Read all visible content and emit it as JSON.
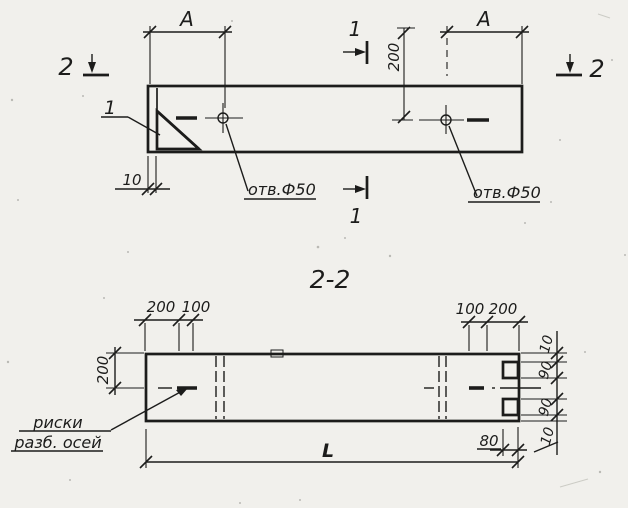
{
  "colors": {
    "ink": "#1c1c1b",
    "paper": "#f1f0ec"
  },
  "top_view": {
    "section_mark_left": "2",
    "section_mark_right": "2",
    "section_mark_top": "1",
    "section_mark_bottom": "1",
    "dim_a_left": "А",
    "dim_a_right": "А",
    "dim_edge_to_hole": "200",
    "dim_lip": "10",
    "hole_label_left": "отв.Ф50",
    "hole_label_right": "отв.Ф50",
    "detail_mark": "1"
  },
  "section_view": {
    "title": "2-2",
    "dims_top_left": [
      "200",
      "100"
    ],
    "dims_top_right": [
      "100",
      "200"
    ],
    "dim_left_vertical": "200",
    "dims_right_vertical": [
      "10",
      "90",
      "90",
      "10"
    ],
    "dim_length": "L",
    "dim_offset_80": "80",
    "note_line1": "риски",
    "note_line2": "разб. осей"
  }
}
